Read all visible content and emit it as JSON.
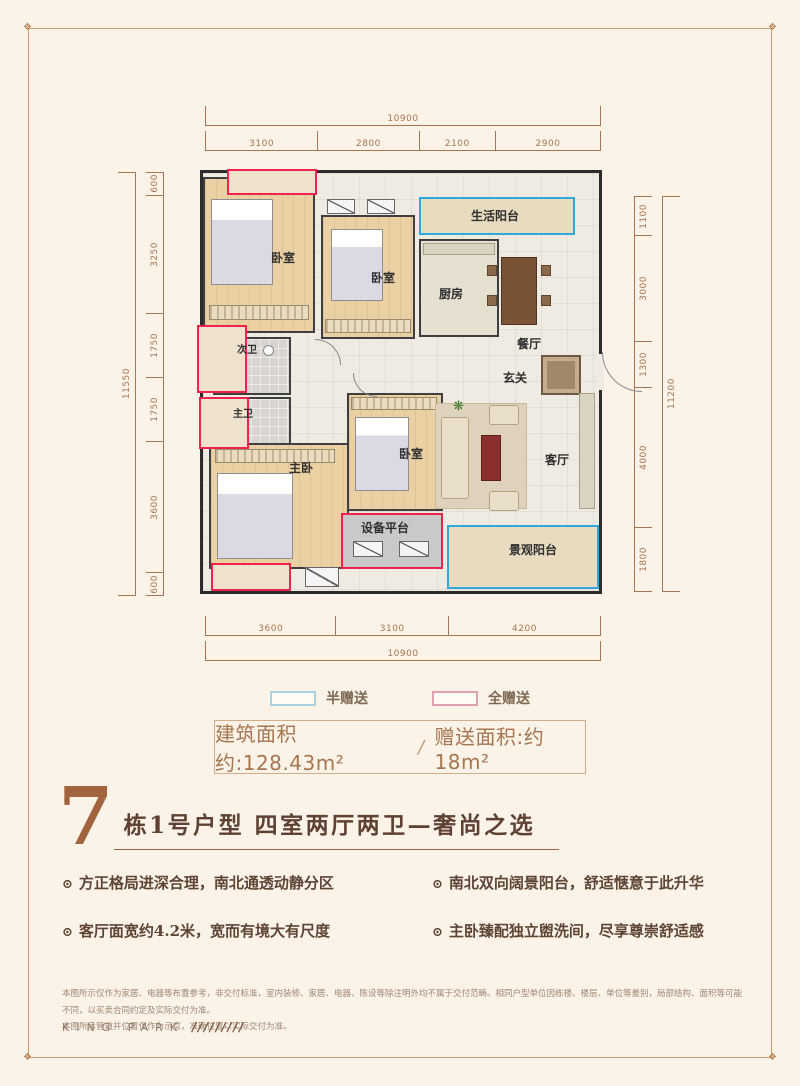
{
  "colors": {
    "background": "#fbf2e8",
    "half_gift_accent": "#2fa8dc",
    "full_gift_accent": "#f0234e",
    "dimension_lines": "#a5764f",
    "title_accent": "#a2643e"
  },
  "floorplan": {
    "dimensions": {
      "top": {
        "total": "10900",
        "segments": [
          "3100",
          "2800",
          "2100",
          "2900"
        ]
      },
      "left": {
        "total": "11550",
        "segments": [
          "600",
          "3250",
          "1750",
          "1750",
          "3600",
          "600"
        ]
      },
      "right": {
        "total": "11200",
        "segments": [
          "1100",
          "3000",
          "1300",
          "4000",
          "1800"
        ]
      },
      "bottom": {
        "total": "10900",
        "segments": [
          "3600",
          "3100",
          "4200"
        ]
      }
    },
    "rooms": {
      "bedroom_top_left": "卧室",
      "bedroom_top_mid": "卧室",
      "life_balcony": "生活阳台",
      "kitchen": "厨房",
      "dining_room": "餐厅",
      "foyer": "玄关",
      "second_bath": "次卫",
      "master_bath": "主卫",
      "master_bedroom": "主卧",
      "bedroom_mid": "卧室",
      "living_room": "客厅",
      "equipment_platform": "设备平台",
      "view_balcony": "景观阳台"
    }
  },
  "legend": {
    "half_gift": "半赠送",
    "full_gift": "全赠送"
  },
  "area_summary": {
    "build_area": "建筑面积约:128.43m²",
    "separator": "/",
    "gift_area": "赠送面积:约18m²"
  },
  "title": {
    "block_number": "7",
    "text": "栋1号户型 四室两厅两卫—奢尚之选"
  },
  "features_bullet": "⊙",
  "features": [
    "方正格局进深合理，南北通透动静分区",
    "南北双向阔景阳台，舒适惬意于此升华",
    "客厅面宽约4.2米，宽而有境大有尺度",
    "主卧臻配独立盥洗间，尽享尊崇舒适感"
  ],
  "disclaimer": {
    "line1": "本图所示仅作为家居、电器等布置参考，非交付标准，室内装修、家居、电器、陈设等除注明外均不属于交付范畴。相同户型单位因栋楼、楼层、单位等差别，局部结构、面积等可能不同，以买卖合同约定及实际交付为准。",
    "line2": "本图所示管道井位置仅作为示意，准确位置以实际交付为准。",
    "brand": "KING PARK",
    "slashes": "/////////"
  }
}
